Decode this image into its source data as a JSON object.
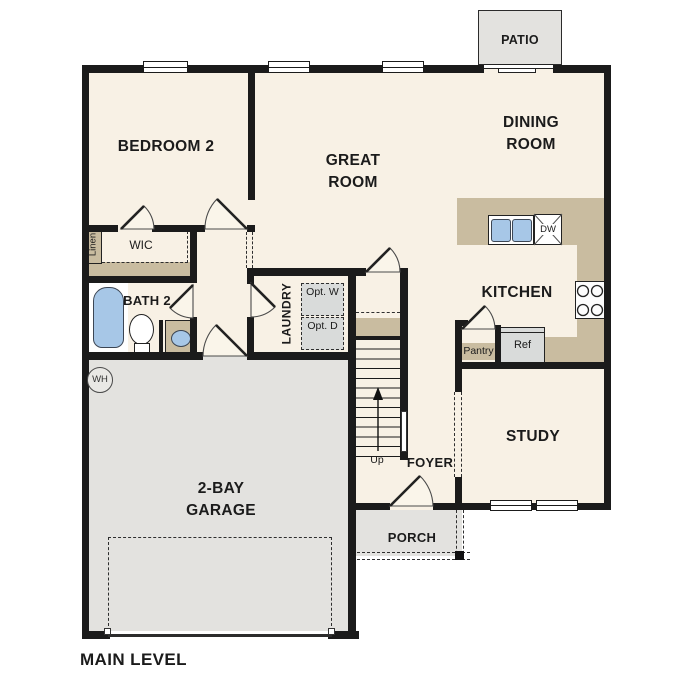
{
  "title": "MAIN LEVEL",
  "rooms": {
    "bedroom2": "BEDROOM 2",
    "great_room": {
      "l1": "GREAT",
      "l2": "ROOM"
    },
    "dining_room": {
      "l1": "DINING",
      "l2": "ROOM"
    },
    "kitchen": "KITCHEN",
    "bath2": "BATH 2",
    "wic": "WIC",
    "linen": "Linen",
    "laundry": "LAUNDRY",
    "study": "STUDY",
    "foyer": "FOYER",
    "porch": "PORCH",
    "patio": "PATIO",
    "garage": {
      "l1": "2-BAY",
      "l2": "GARAGE"
    }
  },
  "fixtures": {
    "opt_washer": {
      "l1": "Opt.",
      "l2": "W"
    },
    "opt_dryer": {
      "l1": "Opt.",
      "l2": "D"
    },
    "pantry": "Pantry",
    "refrigerator": "Ref",
    "dishwasher": "DW",
    "stairs_up": "Up",
    "water_heater": "WH"
  },
  "colors": {
    "floor": "#f8f1e5",
    "counter_tan": "#c9bca0",
    "garage_gray": "#e3e2df",
    "appliance_gray": "#d9dbda",
    "fixture_blue": "#a7c7e7",
    "wall": "#1b1b1b"
  }
}
